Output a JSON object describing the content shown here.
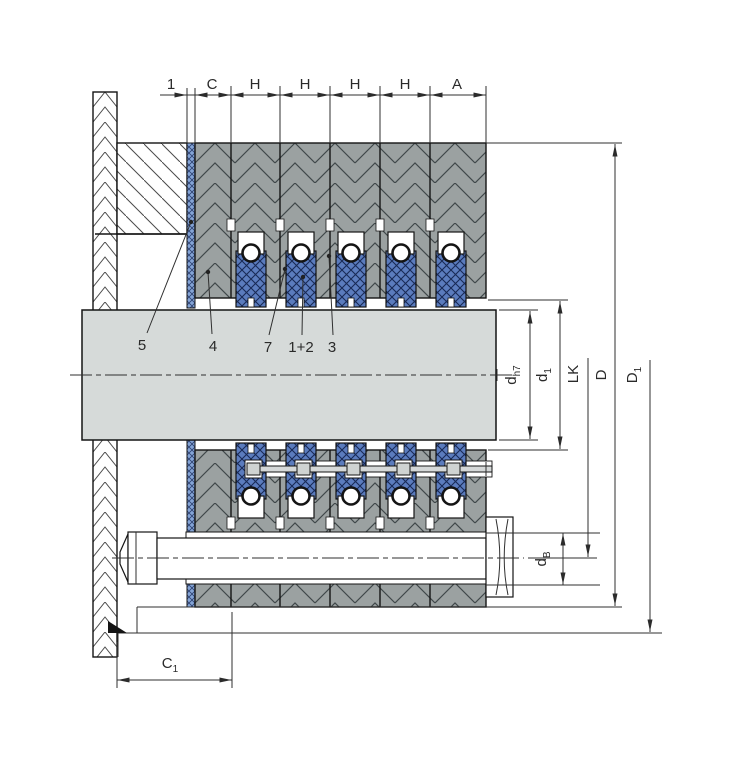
{
  "top_dims": [
    "1",
    "C",
    "H",
    "H",
    "H",
    "H",
    "A"
  ],
  "parts": [
    "5",
    "4",
    "7",
    "1+2",
    "3"
  ],
  "dims": {
    "shaft": {
      "base": "d",
      "sub": "h7"
    },
    "inner": {
      "base": "d",
      "sub": "1"
    },
    "bolt_circle": {
      "base": "LK",
      "sub": ""
    },
    "outer": {
      "base": "D",
      "sub": ""
    },
    "flange": {
      "base": "D",
      "sub": "1"
    },
    "bolt": {
      "base": "d",
      "sub": "B"
    },
    "depth": {
      "base": "C",
      "sub": "1"
    }
  },
  "colors": {
    "packing_blue": "#5b7cbe",
    "gasket_blue": "#84a4d6",
    "housing_gray": "#9ba1a1",
    "shaft_gray": "#d6dad9",
    "line": "#2b2b2b"
  }
}
